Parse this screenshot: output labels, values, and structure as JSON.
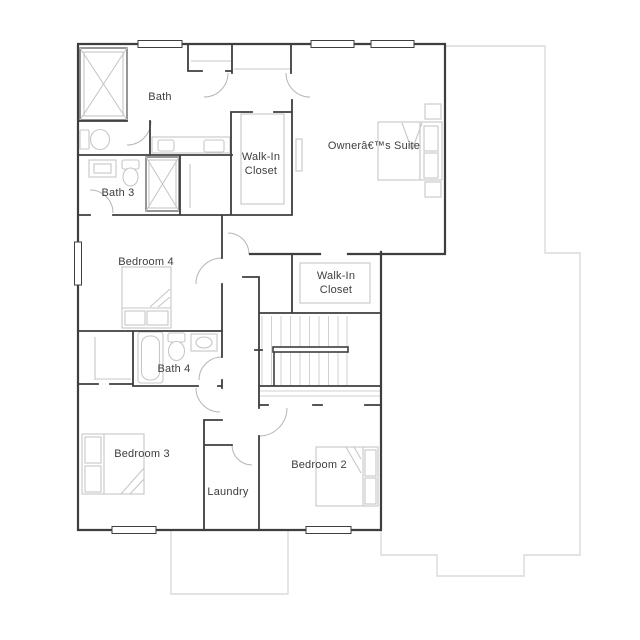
{
  "plan": {
    "type": "floor-plan",
    "floor": "second-floor",
    "rooms": {
      "bath": "Bath",
      "bath3": "Bath 3",
      "walk_in_1_line1": "Walk-In",
      "walk_in_1_line2": "Closet",
      "owners_suite": "Ownerâ€™s Suite",
      "bedroom4": "Bedroom 4",
      "walk_in_2_line1": "Walk-In",
      "walk_in_2_line2": "Closet",
      "bath4": "Bath 4",
      "bedroom3": "Bedroom 3",
      "laundry": "Laundry",
      "bedroom2": "Bedroom 2"
    },
    "colors": {
      "wall": "#3e3e3e",
      "door": "#b5b5b5",
      "fixture": "#c7c7c7",
      "ghost": "#dadada",
      "tread": "#d2d2d2",
      "text": "#3d3d3d",
      "paper": "#ffffff"
    }
  }
}
